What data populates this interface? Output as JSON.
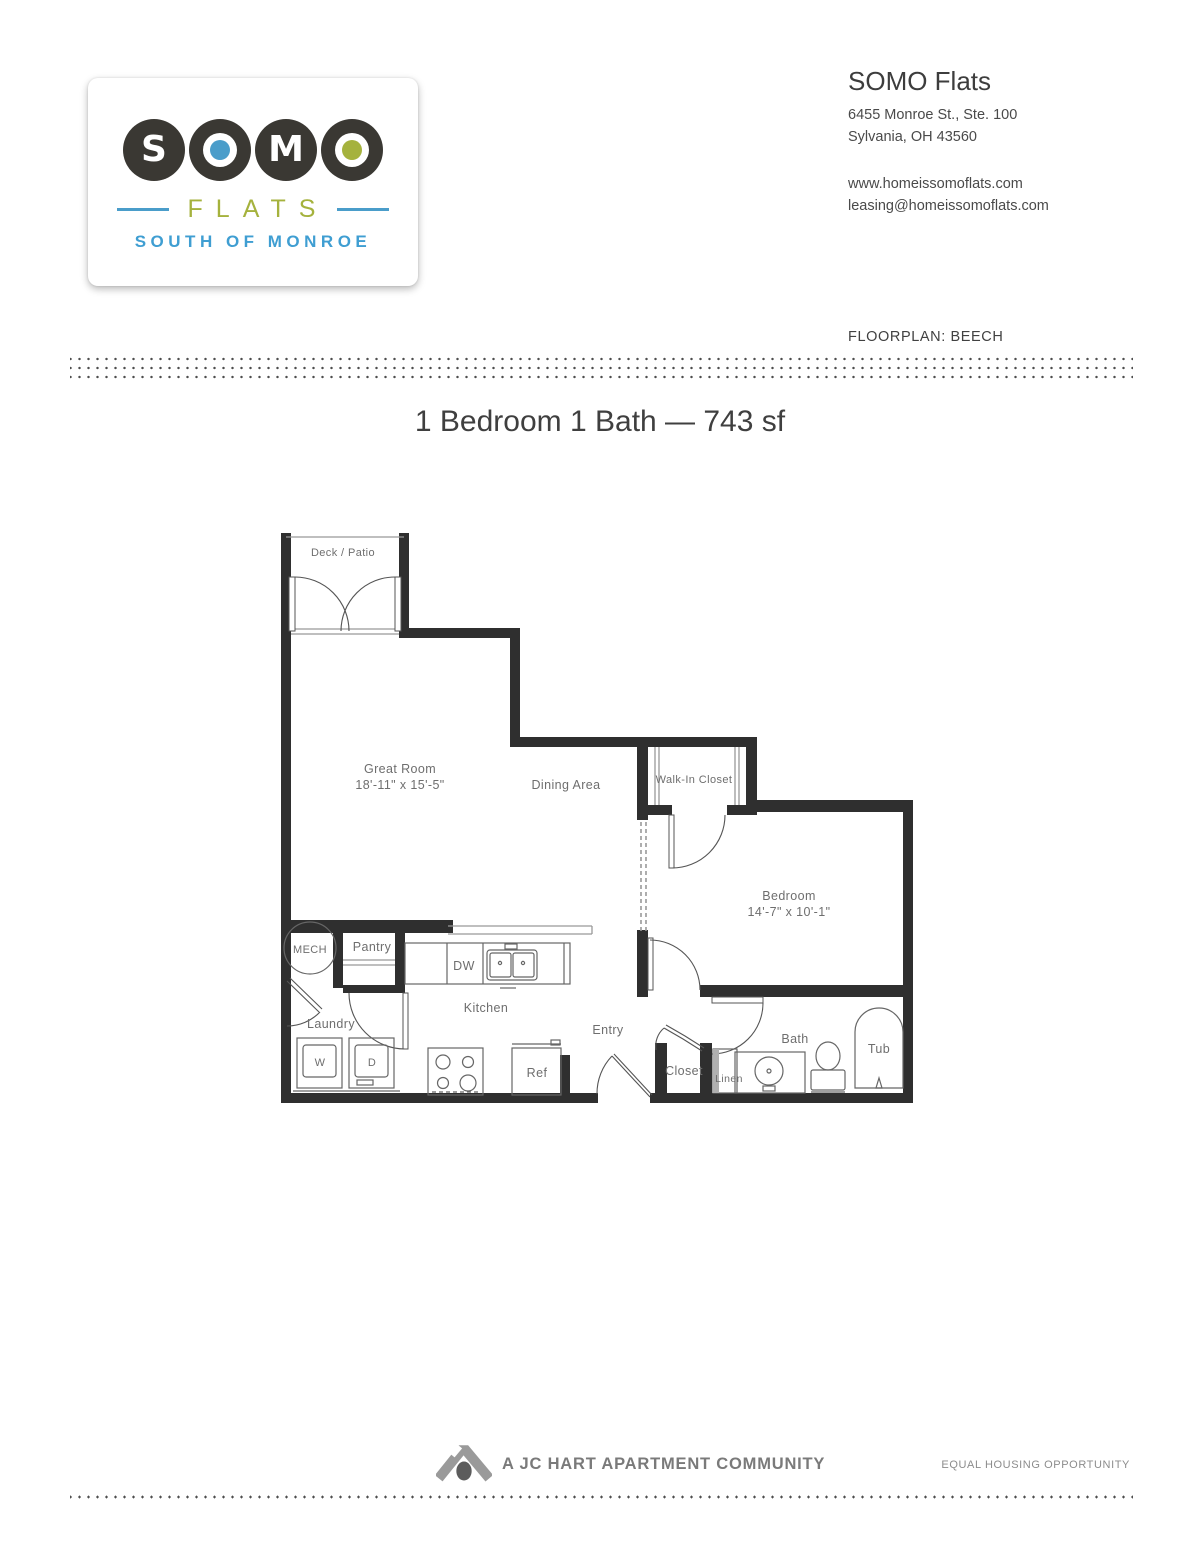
{
  "logo": {
    "letters": [
      "S",
      "O",
      "M",
      "O"
    ],
    "wordmark": "FLATS",
    "tagline": "SOUTH OF MONROE",
    "colors": {
      "brand_dark": "#3a3833",
      "brand_blue": "#4a9dca",
      "brand_green": "#a5b23d"
    }
  },
  "header": {
    "company": "SOMO Flats",
    "address_line1": "6455 Monroe St., Ste. 100",
    "address_line2": "Sylvania, OH 43560",
    "website": "www.homeissomoflats.com",
    "email": "leasing@homeissomoflats.com",
    "floorplan_label": "FLOORPLAN: BEECH"
  },
  "title": "1 Bedroom 1 Bath — 743 sf",
  "plan": {
    "deck": "Deck / Patio",
    "great_room": "Great Room",
    "great_room_dims": "18'-11\" x 15'-5\"",
    "dining": "Dining Area",
    "walk_in_closet": "Walk-In Closet",
    "bedroom": "Bedroom",
    "bedroom_dims": "14'-7\" x 10'-1\"",
    "mech": "MECH",
    "pantry": "Pantry",
    "kitchen": "Kitchen",
    "laundry": "Laundry",
    "entry": "Entry",
    "closet": "Closet",
    "linen": "Linen",
    "bath": "Bath",
    "tub": "Tub",
    "washer": "W",
    "dryer": "D",
    "dishwasher": "DW",
    "fridge": "Ref"
  },
  "footer": {
    "community": "A JC HART APARTMENT COMMUNITY",
    "equal_housing": "EQUAL HOUSING OPPORTUNITY"
  }
}
